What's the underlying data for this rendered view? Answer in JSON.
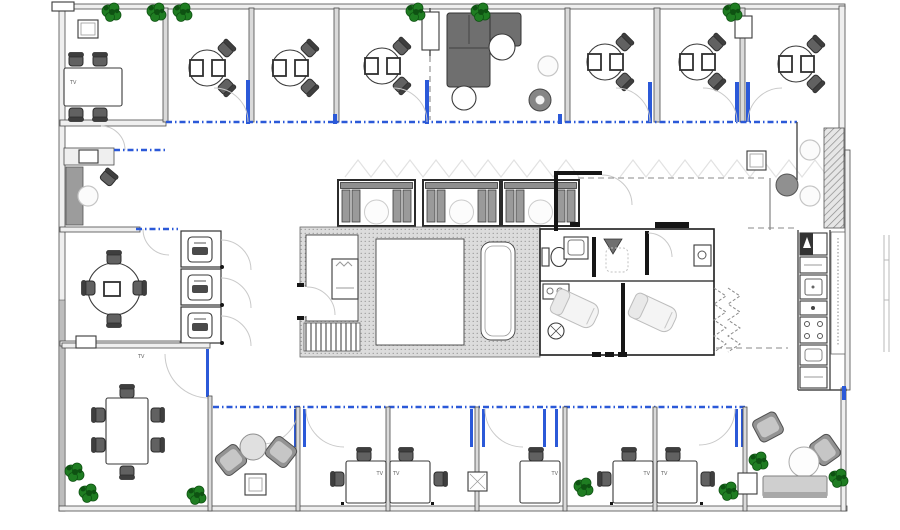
{
  "labels": {
    "tv": "TV"
  },
  "colors": {
    "wall": "#4a4a4a",
    "wallFill": "#efefef",
    "partition": "#dadada",
    "glass": "#2b59d8",
    "plant": "#1f7d22",
    "plantDark": "#0e5212",
    "sofa": "#6f6f6f",
    "loungeChair": "#939393",
    "table": "#ffffff",
    "arc": "#c9c9c9"
  }
}
